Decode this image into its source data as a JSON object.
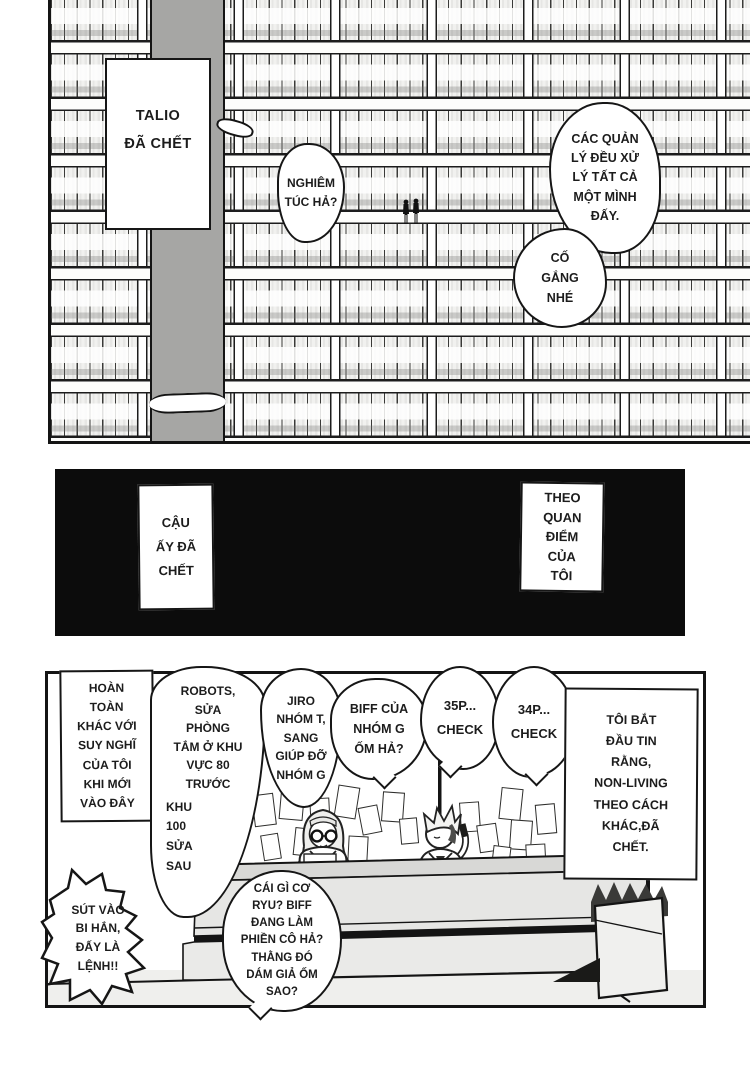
{
  "panel1": {
    "caption_talio": "TALIO\nĐÃ CHẾT",
    "bubble_nghiem_tuc": "NGHIÊM\nTÚC HẢ?",
    "bubble_cac_quan_ly": "CÁC QUẢN\nLÝ ĐỀU XỬ\nLÝ TẤT CẢ\nMỘT MÌNH\nĐẤY.",
    "bubble_co_gang": "CỐ\nGẮNG\nNHÉ"
  },
  "panel2": {
    "caption_cau_ay": "CẬU\nẤY ĐÃ\nCHẾT",
    "caption_theo_quan_diem": "THEO\nQUAN\nĐIỂM\nCỦA\nTÔI"
  },
  "panel3": {
    "caption_hoan_toan": "HOÀN\nTOÀN\nKHÁC VỚI\nSUY NGHĨ\nCỦA TÔI\nKHI MỚI\nVÀO ĐÂY",
    "bubble_robots_top": "ROBOTS,\nSỬA\nPHÒNG\nTẮM Ở KHU\nVỰC 80\nTRƯỚC",
    "bubble_robots_bottom": "KHU\n100\nSỬA\nSAU",
    "bubble_jiro": "JIRO\nNHÓM T,\nSANG\nGIÚP ĐỠ\nNHÓM G",
    "bubble_biff": "BIFF CỦA\nNHÓM G\nỐM HẢ?",
    "bubble_35p": "35P...\nCHECK",
    "bubble_34p": "34P...\nCHECK",
    "caption_toi_bat_dau": "TÔI BẮT\nĐẦU TIN\nRẰNG,\nNON-LIVING\nTHEO CÁCH\nKHÁC,ĐÃ\nCHẾT.",
    "bubble_sut_vao": "SÚT VÀO\nBI HẮN,\nĐẤY LÀ\nLỆNH!!",
    "bubble_cai_gi": "CÁI GÌ CƠ\nRYU? BIFF\nĐANG LÀM\nPHIỀN CÔ HẢ?\nTHẰNG ĐÓ\nDÁM GIẢ ỐM\nSAO?"
  },
  "colors": {
    "ink": "#141414",
    "pillar_gray": "#a6a6a4",
    "black_panel": "#0c0c0c",
    "desk_gray": "#e6e6e4",
    "floor_gray": "#efefed"
  }
}
